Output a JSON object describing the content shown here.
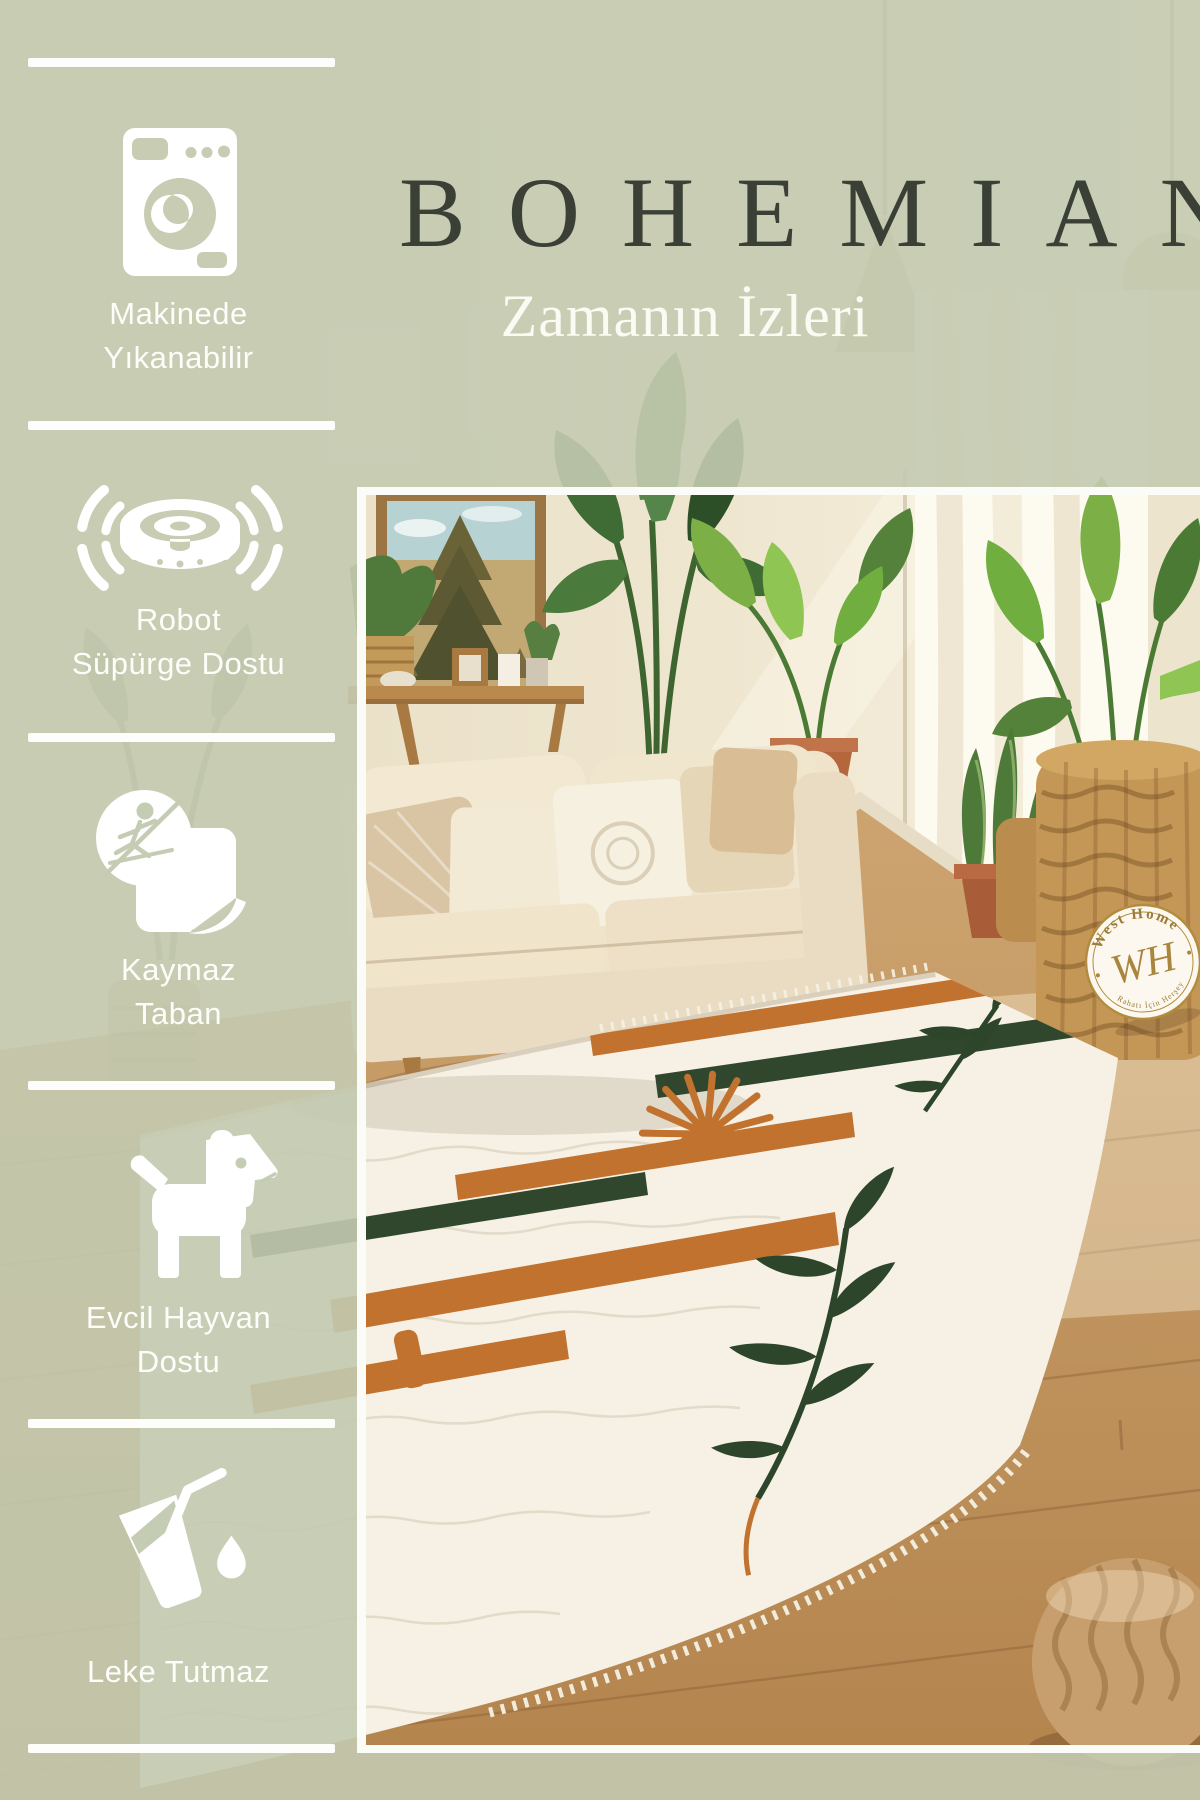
{
  "brand": {
    "title": "BOHEMIAN",
    "subtitle": "Zamanın İzleri"
  },
  "features": [
    {
      "id": "machine-washable",
      "icon": "washing-machine-icon",
      "lines": [
        "Makinede",
        "Yıkanabilir"
      ]
    },
    {
      "id": "robot-vacuum-friendly",
      "icon": "robot-vacuum-icon",
      "lines": [
        "Robot",
        "Süpürge Dostu"
      ]
    },
    {
      "id": "non-slip-base",
      "icon": "non-slip-rug-icon",
      "lines": [
        "Kaymaz",
        "Taban"
      ]
    },
    {
      "id": "pet-friendly",
      "icon": "dog-icon",
      "lines": [
        "Evcil Hayvan",
        "Dostu"
      ]
    },
    {
      "id": "stain-resistant",
      "icon": "spill-glass-icon",
      "lines": [
        "Leke Tutmaz"
      ]
    }
  ],
  "badge": {
    "arc_top": "West Home",
    "monogram": "WH",
    "arc_bottom": "Rahatı İçin Herşey"
  },
  "colors": {
    "overlay_sage": "#c3cab0",
    "title_text": "#3b4037",
    "feature_text": "#fdfdfa",
    "frame_white": "#fbfbf8",
    "rug_orange": "#c0722e",
    "rug_green": "#31472d",
    "badge_gold": "#9c7c35"
  }
}
